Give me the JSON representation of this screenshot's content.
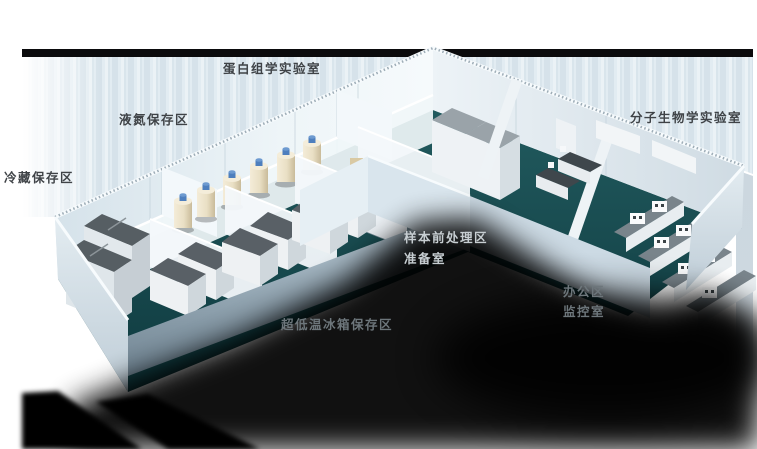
{
  "colors": {
    "top_bar": "#0b0b0d",
    "backdrop": "#dfe9f0",
    "wall_light": "#f0f6f9",
    "wall_mid": "#dce7ee",
    "wall_shade": "#c9d6de",
    "floor_teal": "#1a4d51",
    "floor_teal_dark": "#0f3a3f",
    "floor_gray": "#7d919d",
    "equip_dark": "#565e63",
    "equip_light": "#eef1f3",
    "tank_body": "#eee4ca",
    "tank_cap": "#4e7fbe",
    "shadow": "#000000",
    "label_dark": "#3f4347",
    "label_light": "#c7ced2",
    "label_gray": "#6d767b"
  },
  "labels": [
    {
      "id": "proteomics-lab",
      "text": "蛋白组学实验室",
      "x": 223,
      "y": 61,
      "tone": "dark"
    },
    {
      "id": "liquid-nitrogen-area",
      "text": "液氮保存区",
      "x": 119,
      "y": 112,
      "tone": "dark"
    },
    {
      "id": "cold-storage-area",
      "text": "冷藏保存区",
      "x": 4,
      "y": 170,
      "tone": "dark"
    },
    {
      "id": "molecular-bio-lab",
      "text": "分子生物学实验室",
      "x": 630,
      "y": 110,
      "tone": "dark"
    },
    {
      "id": "sample-pretreatment",
      "text": "样本前处理区",
      "x": 404,
      "y": 230,
      "tone": "light"
    },
    {
      "id": "preparation-room",
      "text": "准备室",
      "x": 404,
      "y": 251,
      "tone": "light"
    },
    {
      "id": "office-area",
      "text": "办公区",
      "x": 563,
      "y": 284,
      "tone": "gray"
    },
    {
      "id": "monitoring-room",
      "text": "监控室",
      "x": 563,
      "y": 304,
      "tone": "gray"
    },
    {
      "id": "ult-freezer-area",
      "text": "超低温冰箱保存区",
      "x": 281,
      "y": 317,
      "tone": "gray"
    }
  ]
}
